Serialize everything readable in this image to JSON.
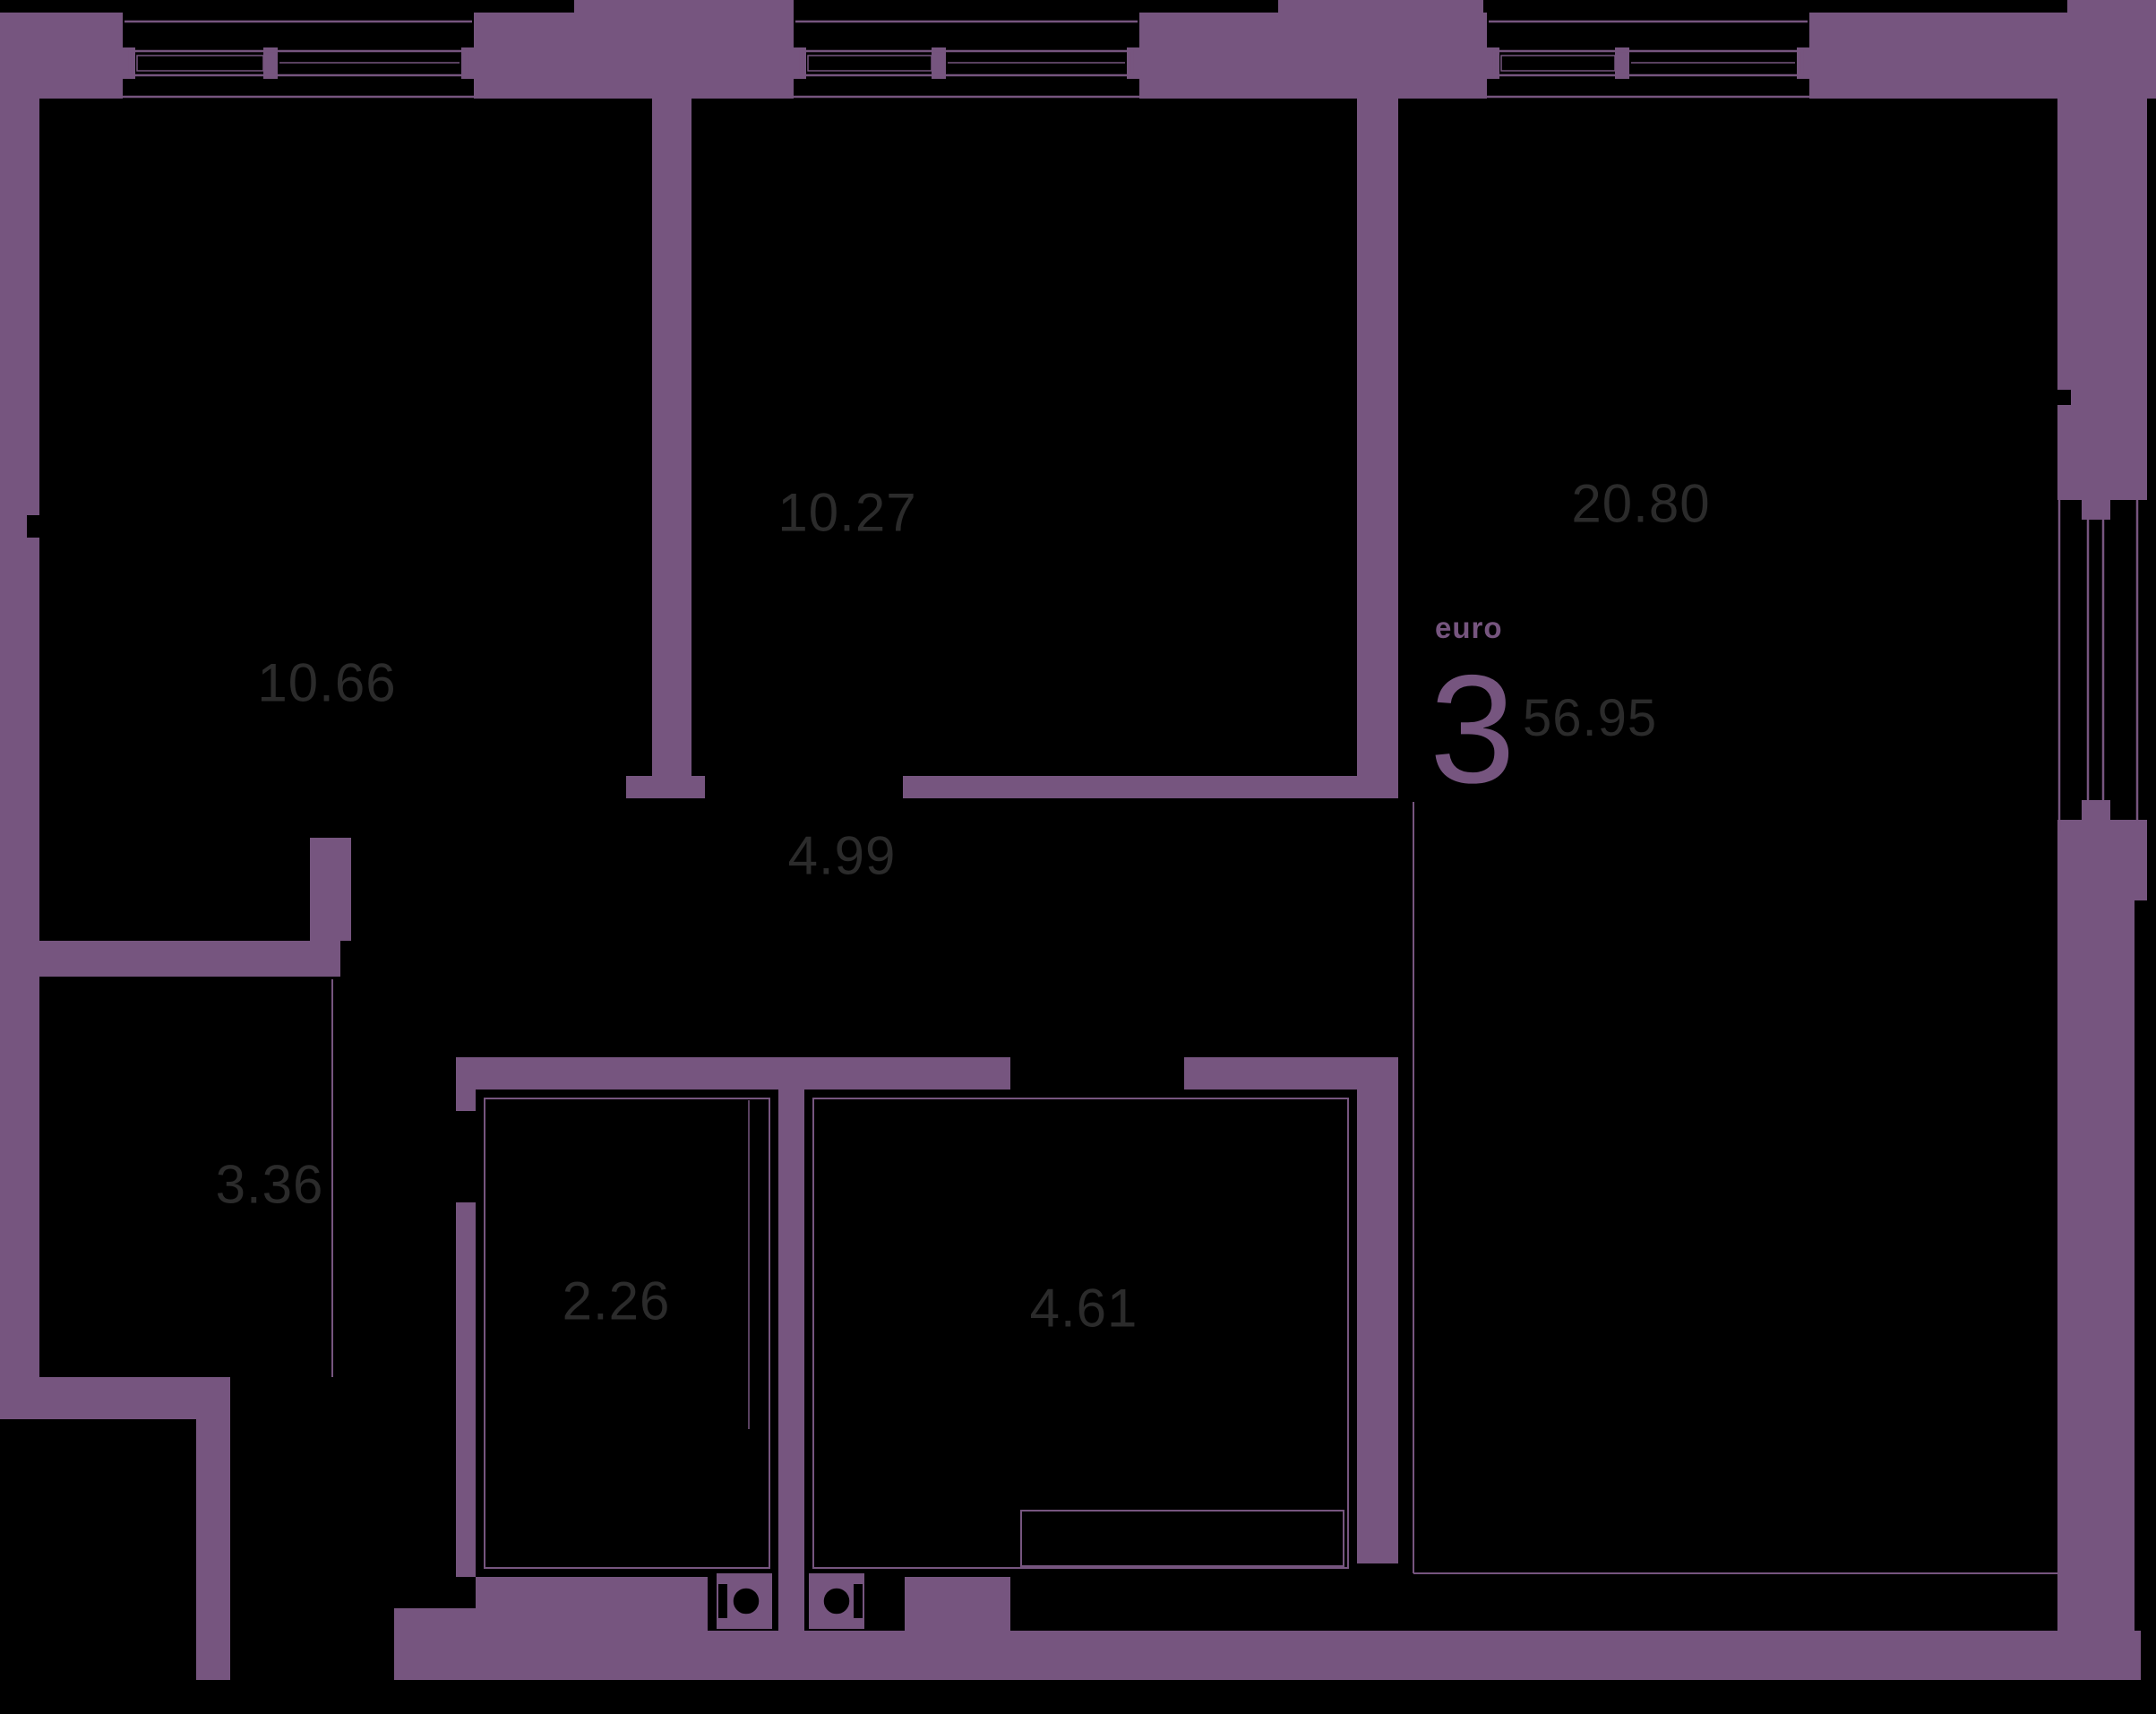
{
  "plan": {
    "unit_type_label": "euro",
    "unit_rooms_number": "3",
    "total_area": "56.95",
    "rooms": [
      {
        "id": "bedroom-1",
        "area": "10.66"
      },
      {
        "id": "bedroom-2",
        "area": "10.27"
      },
      {
        "id": "living-kitchen",
        "area": "20.80"
      },
      {
        "id": "corridor",
        "area": "4.99"
      },
      {
        "id": "hallway",
        "area": "3.36"
      },
      {
        "id": "wc",
        "area": "2.26"
      },
      {
        "id": "bathroom",
        "area": "4.61"
      }
    ],
    "colors": {
      "wall": "#76557F",
      "label": "#2b2b2b",
      "background": "#000000"
    }
  }
}
